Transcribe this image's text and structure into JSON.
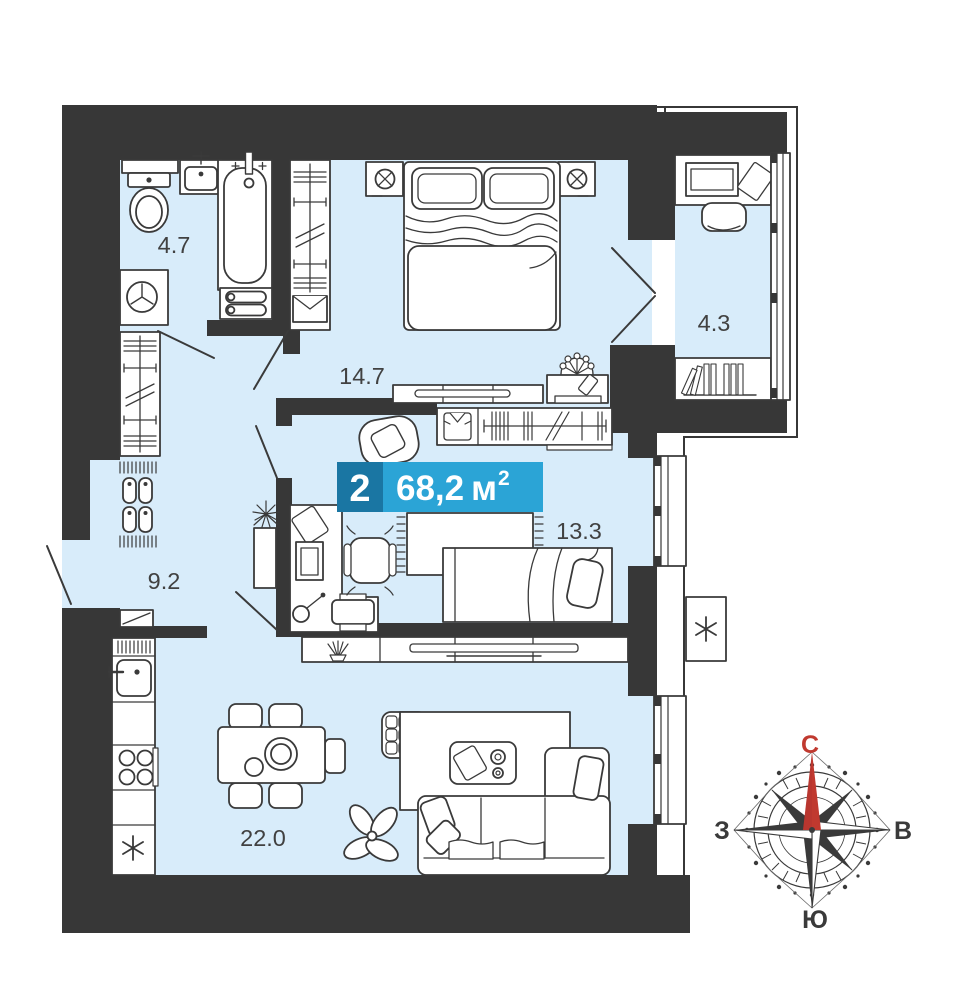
{
  "page": {
    "background_color": "#ffffff"
  },
  "floor_plan": {
    "badge": {
      "rooms_count": "2",
      "area_value": "68,2",
      "area_unit": "м",
      "area_superscript": "2",
      "rooms_count_bg": "#1a76a3",
      "area_bg": "#2ba4d6",
      "text_color": "#ffffff"
    },
    "rooms": [
      {
        "name": "bathroom",
        "area_label": "4.7"
      },
      {
        "name": "bedroom",
        "area_label": "14.7"
      },
      {
        "name": "balcony",
        "area_label": "4.3"
      },
      {
        "name": "bedroom-2",
        "area_label": "13.3"
      },
      {
        "name": "hallway",
        "area_label": "9.2"
      },
      {
        "name": "kitchen-living-room",
        "area_label": "22.0"
      }
    ],
    "compass": {
      "north_label": "С",
      "south_label": "Ю",
      "west_label": "З",
      "east_label": "В",
      "north_color": "#c0392f",
      "dark_color": "#3a3a3a"
    },
    "colors": {
      "wall": "#373737",
      "room_fill": "#d8ecfa",
      "line": "#3a3a3a",
      "label_text": "#414141"
    }
  }
}
